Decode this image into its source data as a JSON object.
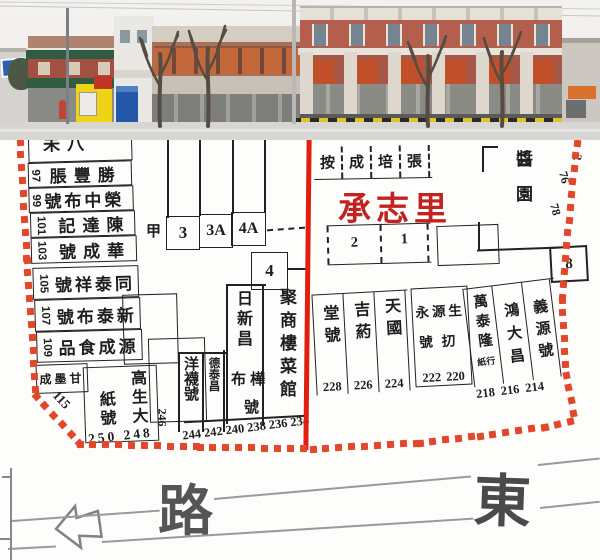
{
  "photo": {
    "description": "street facade panorama above map",
    "colors": {
      "awning_green": "#2f5c43",
      "shop_yellow": "#f0d216",
      "kiosk_blue": "#2458a8",
      "brick_red": "#b45f4e",
      "shutter_orange": "#c1502a",
      "curb_yellow": "#e0c22a"
    }
  },
  "map": {
    "colors": {
      "boundary": "#e1472b",
      "red_line": "#e01f10",
      "label_red": "#c32222",
      "ink": "#1e1e1e"
    },
    "landmark": "承志里",
    "left_rows": [
      {
        "num": "",
        "shop": "未八"
      },
      {
        "num": "97",
        "shop": "脹豐勝"
      },
      {
        "num": "99",
        "shop": "號布中榮"
      },
      {
        "num": "101",
        "shop": "記達陳"
      },
      {
        "num": "103",
        "shop": "號成華"
      },
      {
        "num": "105",
        "shop": "號祥泰同"
      },
      {
        "num": "107",
        "shop": "號布泰新"
      },
      {
        "num": "109",
        "shop": "品食成源"
      }
    ],
    "gan": "成墨甘",
    "gao": {
      "col_r": "高生大",
      "col_l": "紙號",
      "nums": "250 248"
    },
    "n115": "115",
    "n246": "246",
    "lots": {
      "a": "3",
      "b": "3A",
      "c": "4A",
      "d": "4",
      "jia": "甲"
    },
    "cols": {
      "yang": "洋襪號",
      "de": "德泰昌",
      "ri": "日新昌",
      "buhua": "布樺",
      "hao": "號",
      "ju": "聚商樓菜館"
    },
    "bnums": [
      "244",
      "242",
      "240",
      "238",
      "236",
      "234"
    ],
    "top_row": [
      "按",
      "成",
      "培",
      "張"
    ],
    "units": [
      "2",
      "1"
    ],
    "pharm": [
      {
        "t": "堂號",
        "n": "228"
      },
      {
        "t": "吉葯",
        "n": "226"
      },
      {
        "t": "天國",
        "n": "224"
      }
    ],
    "yy": {
      "r1": "永源生",
      "r2": "號㧅",
      "n1": "222",
      "n2": "220"
    },
    "east": {
      "c1": "萬泰隆",
      "c1s": "紙行",
      "c2": "鴻大昌",
      "c3": "義源號",
      "n1": "218",
      "n2": "216",
      "n3": "214"
    },
    "jiang": "醬園",
    "n8": "8",
    "redge": [
      "2",
      "76",
      "78"
    ],
    "street": {
      "lu": "路",
      "dong": "東"
    }
  }
}
